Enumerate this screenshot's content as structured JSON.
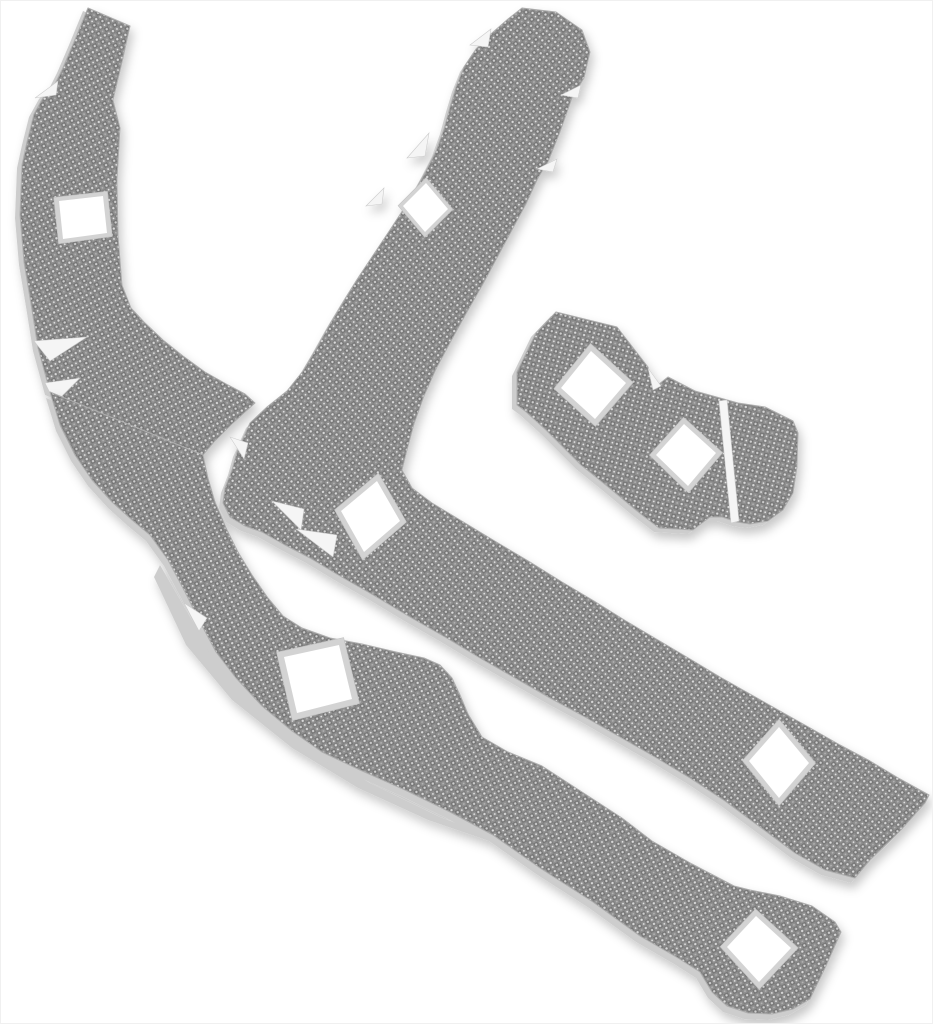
{
  "meta": {
    "type": "product-photo",
    "subject": "heat-shield liner kit of four woven-metal pieces with square mounting cutouts",
    "background_color": "#ffffff",
    "piece_count": 4,
    "mounting_hole_count": 8
  },
  "palette": {
    "weave_base": "#8f8f8f",
    "weave_dark": "#757575",
    "weave_dark2": "#7e7e7e",
    "weave_light": "#cfcfcf",
    "weave_bright": "#e8e8e8",
    "weave_mid": "#b5b5b5",
    "weave_light2": "#dadada",
    "backing": "#cdcdcd",
    "edge_stroke": "#adadad",
    "hole_border": "#d3d3d3",
    "hole_border_stroke": "#c2c2c2",
    "hole_fill": "#ffffff",
    "slit_fill": "#f5f5f5",
    "slit_stroke": "#cccccc",
    "shadow_color": "#000000",
    "shadow_opacity": 0.22
  },
  "weave_tile": {
    "size": 9.2,
    "dot_pitch": 4.6
  },
  "pieces": [
    {
      "id": "piece-left-upper",
      "name": "heat-shield-piece-left-upper-arm",
      "weave_rotation": 62,
      "backing_offset": [
        -5,
        3
      ],
      "outline": [
        [
          88,
          8
        ],
        [
          130,
          26
        ],
        [
          123,
          58
        ],
        [
          113,
          100
        ],
        [
          120,
          128
        ],
        [
          117,
          180
        ],
        [
          118,
          235
        ],
        [
          122,
          285
        ],
        [
          131,
          308
        ],
        [
          144,
          322
        ],
        [
          163,
          340
        ],
        [
          183,
          356
        ],
        [
          205,
          372
        ],
        [
          228,
          385
        ],
        [
          245,
          394
        ],
        [
          255,
          403
        ],
        [
          232,
          424
        ],
        [
          214,
          442
        ],
        [
          203,
          455
        ],
        [
          50,
          392
        ],
        [
          38,
          348
        ],
        [
          32,
          310
        ],
        [
          24,
          262
        ],
        [
          20,
          215
        ],
        [
          22,
          165
        ],
        [
          27,
          142
        ],
        [
          34,
          114
        ],
        [
          44,
          96
        ],
        [
          54,
          86
        ],
        [
          62,
          70
        ],
        [
          74,
          42
        ]
      ],
      "holes": [
        {
          "points": [
            [
              59,
              201
            ],
            [
              103,
              196
            ],
            [
              107,
              233
            ],
            [
              63,
              239
            ]
          ]
        }
      ],
      "slits": [
        {
          "points": [
            [
              35,
              98
            ],
            [
              58,
              81
            ],
            [
              56,
              95
            ]
          ]
        },
        {
          "points": [
            [
              34,
              341
            ],
            [
              87,
              337
            ],
            [
              50,
              361
            ]
          ]
        },
        {
          "points": [
            [
              45,
              383
            ],
            [
              80,
              378
            ],
            [
              55,
              403
            ]
          ]
        }
      ],
      "underlays": []
    },
    {
      "id": "piece-left-lower",
      "name": "heat-shield-piece-left-lower-strip",
      "weave_rotation": -27,
      "backing_offset": [
        -4,
        6
      ],
      "outline": [
        [
          50,
          392
        ],
        [
          60,
          425
        ],
        [
          75,
          455
        ],
        [
          92,
          480
        ],
        [
          112,
          502
        ],
        [
          132,
          520
        ],
        [
          150,
          535
        ],
        [
          168,
          560
        ],
        [
          185,
          592
        ],
        [
          200,
          622
        ],
        [
          216,
          652
        ],
        [
          236,
          678
        ],
        [
          262,
          706
        ],
        [
          292,
          731
        ],
        [
          322,
          752
        ],
        [
          360,
          770
        ],
        [
          405,
          790
        ],
        [
          450,
          812
        ],
        [
          493,
          835
        ],
        [
          540,
          868
        ],
        [
          593,
          902
        ],
        [
          640,
          936
        ],
        [
          678,
          958
        ],
        [
          700,
          972
        ],
        [
          712,
          992
        ],
        [
          727,
          1006
        ],
        [
          748,
          1013
        ],
        [
          772,
          1014
        ],
        [
          793,
          1009
        ],
        [
          810,
          999
        ],
        [
          826,
          966
        ],
        [
          841,
          932
        ],
        [
          835,
          922
        ],
        [
          812,
          906
        ],
        [
          780,
          896
        ],
        [
          750,
          890
        ],
        [
          734,
          886
        ],
        [
          692,
          864
        ],
        [
          652,
          841
        ],
        [
          622,
          818
        ],
        [
          582,
          792
        ],
        [
          542,
          766
        ],
        [
          508,
          752
        ],
        [
          482,
          737
        ],
        [
          468,
          714
        ],
        [
          460,
          695
        ],
        [
          452,
          678
        ],
        [
          440,
          665
        ],
        [
          424,
          658
        ],
        [
          396,
          652
        ],
        [
          362,
          644
        ],
        [
          330,
          638
        ],
        [
          302,
          628
        ],
        [
          283,
          616
        ],
        [
          268,
          598
        ],
        [
          252,
          575
        ],
        [
          238,
          552
        ],
        [
          226,
          528
        ],
        [
          215,
          502
        ],
        [
          208,
          478
        ],
        [
          203,
          455
        ]
      ],
      "holes": [
        {
          "points": [
            [
              284,
              657
            ],
            [
              339,
              645
            ],
            [
              352,
              699
            ],
            [
              297,
              713
            ]
          ]
        },
        {
          "points": [
            [
              727,
              947
            ],
            [
              756,
              916
            ],
            [
              791,
              948
            ],
            [
              759,
              982
            ]
          ]
        }
      ],
      "slits": [
        {
          "points": [
            [
              184,
              603
            ],
            [
              199,
              631
            ],
            [
              207,
              618
            ]
          ]
        }
      ],
      "underlays": [
        {
          "points": [
            [
              160,
              565
            ],
            [
              200,
              634
            ],
            [
              242,
              690
            ],
            [
              300,
              742
            ],
            [
              370,
              783
            ],
            [
              440,
              817
            ],
            [
              500,
              840
            ],
            [
              530,
              850
            ],
            [
              492,
              842
            ],
            [
              428,
              820
            ],
            [
              358,
              788
            ],
            [
              292,
              748
            ],
            [
              232,
              700
            ],
            [
              186,
              645
            ],
            [
              154,
              577
            ]
          ]
        }
      ]
    },
    {
      "id": "piece-middle",
      "name": "heat-shield-piece-middle-boomerang",
      "weave_rotation": -38,
      "backing_offset": [
        -4,
        5
      ],
      "outline": [
        [
          522,
          8
        ],
        [
          556,
          12
        ],
        [
          582,
          30
        ],
        [
          590,
          52
        ],
        [
          584,
          78
        ],
        [
          572,
          98
        ],
        [
          560,
          132
        ],
        [
          548,
          162
        ],
        [
          538,
          178
        ],
        [
          526,
          204
        ],
        [
          512,
          230
        ],
        [
          498,
          256
        ],
        [
          483,
          284
        ],
        [
          467,
          312
        ],
        [
          451,
          341
        ],
        [
          436,
          369
        ],
        [
          424,
          396
        ],
        [
          414,
          424
        ],
        [
          407,
          450
        ],
        [
          402,
          470
        ],
        [
          412,
          488
        ],
        [
          432,
          503
        ],
        [
          465,
          523
        ],
        [
          498,
          543
        ],
        [
          530,
          562
        ],
        [
          562,
          582
        ],
        [
          594,
          601
        ],
        [
          626,
          621
        ],
        [
          658,
          640
        ],
        [
          690,
          659
        ],
        [
          720,
          677
        ],
        [
          750,
          694
        ],
        [
          780,
          711
        ],
        [
          812,
          729
        ],
        [
          840,
          745
        ],
        [
          870,
          761
        ],
        [
          900,
          779
        ],
        [
          929,
          795
        ],
        [
          925,
          803
        ],
        [
          900,
          831
        ],
        [
          870,
          860
        ],
        [
          855,
          878
        ],
        [
          825,
          870
        ],
        [
          795,
          853
        ],
        [
          760,
          827
        ],
        [
          725,
          801
        ],
        [
          690,
          778
        ],
        [
          655,
          757
        ],
        [
          620,
          737
        ],
        [
          585,
          717
        ],
        [
          550,
          698
        ],
        [
          515,
          678
        ],
        [
          480,
          658
        ],
        [
          445,
          637
        ],
        [
          410,
          617
        ],
        [
          375,
          596
        ],
        [
          340,
          576
        ],
        [
          310,
          558
        ],
        [
          285,
          545
        ],
        [
          262,
          532
        ],
        [
          245,
          526
        ],
        [
          230,
          517
        ],
        [
          223,
          503
        ],
        [
          225,
          488
        ],
        [
          232,
          470
        ],
        [
          237,
          452
        ],
        [
          250,
          423
        ],
        [
          267,
          407
        ],
        [
          287,
          391
        ],
        [
          303,
          371
        ],
        [
          316,
          349
        ],
        [
          330,
          324
        ],
        [
          345,
          299
        ],
        [
          360,
          275
        ],
        [
          376,
          251
        ],
        [
          392,
          227
        ],
        [
          405,
          207
        ],
        [
          416,
          189
        ],
        [
          426,
          171
        ],
        [
          436,
          151
        ],
        [
          444,
          129
        ],
        [
          450,
          107
        ],
        [
          456,
          87
        ],
        [
          464,
          67
        ],
        [
          476,
          49
        ],
        [
          492,
          33
        ],
        [
          508,
          19
        ]
      ],
      "holes": [
        {
          "points": [
            [
              403,
              206
            ],
            [
              426,
              183
            ],
            [
              448,
              209
            ],
            [
              425,
              232
            ]
          ]
        },
        {
          "points": [
            [
              341,
              511
            ],
            [
              377,
              481
            ],
            [
              400,
              521
            ],
            [
              364,
              552
            ]
          ]
        },
        {
          "points": [
            [
              749,
              761
            ],
            [
              779,
              727
            ],
            [
              809,
              763
            ],
            [
              779,
              798
            ]
          ]
        }
      ],
      "slits": [
        {
          "points": [
            [
              470,
              45
            ],
            [
              491,
              29
            ],
            [
              488,
              47
            ]
          ]
        },
        {
          "points": [
            [
              407,
              158
            ],
            [
              429,
              133
            ],
            [
              425,
              156
            ]
          ]
        },
        {
          "points": [
            [
              366,
              206
            ],
            [
              384,
              188
            ],
            [
              382,
              204
            ]
          ]
        },
        {
          "points": [
            [
              230,
              437
            ],
            [
              244,
              459
            ],
            [
              248,
              443
            ]
          ]
        },
        {
          "points": [
            [
              272,
              501
            ],
            [
              301,
              530
            ],
            [
              304,
              509
            ]
          ]
        },
        {
          "points": [
            [
              296,
              529
            ],
            [
              333,
              557
            ],
            [
              337,
              535
            ]
          ]
        },
        {
          "points": [
            [
              561,
              95
            ],
            [
              581,
              85
            ],
            [
              578,
              98
            ]
          ]
        },
        {
          "points": [
            [
              537,
              169
            ],
            [
              557,
              159
            ],
            [
              553,
              172
            ]
          ]
        }
      ],
      "underlays": []
    },
    {
      "id": "piece-small",
      "name": "heat-shield-piece-small-bowtie",
      "weave_rotation": 15,
      "backing_offset": [
        -5,
        4
      ],
      "outline": [
        [
          556,
          312
        ],
        [
          617,
          327
        ],
        [
          648,
          367
        ],
        [
          654,
          388
        ],
        [
          668,
          377
        ],
        [
          695,
          391
        ],
        [
          738,
          403
        ],
        [
          765,
          407
        ],
        [
          793,
          421
        ],
        [
          798,
          433
        ],
        [
          797,
          467
        ],
        [
          793,
          493
        ],
        [
          783,
          510
        ],
        [
          768,
          521
        ],
        [
          750,
          524
        ],
        [
          737,
          522
        ],
        [
          722,
          517
        ],
        [
          710,
          517
        ],
        [
          693,
          530
        ],
        [
          659,
          528
        ],
        [
          637,
          511
        ],
        [
          607,
          486
        ],
        [
          581,
          465
        ],
        [
          546,
          430
        ],
        [
          525,
          411
        ],
        [
          517,
          405
        ],
        [
          517,
          372
        ],
        [
          536,
          333
        ]
      ],
      "holes": [
        {
          "points": [
            [
              561,
              388
            ],
            [
              591,
              351
            ],
            [
              626,
              383
            ],
            [
              595,
              419
            ]
          ]
        },
        {
          "points": [
            [
              656,
              455
            ],
            [
              684,
              424
            ],
            [
              716,
              453
            ],
            [
              688,
              486
            ]
          ]
        }
      ],
      "slits": [
        {
          "points": [
            [
              648,
              368
            ],
            [
              661,
              386
            ],
            [
              653,
              390
            ]
          ]
        },
        {
          "points": [
            [
              719,
              401
            ],
            [
              727,
              400
            ],
            [
              739,
              521
            ],
            [
              731,
              523
            ]
          ]
        }
      ],
      "underlays": []
    }
  ]
}
